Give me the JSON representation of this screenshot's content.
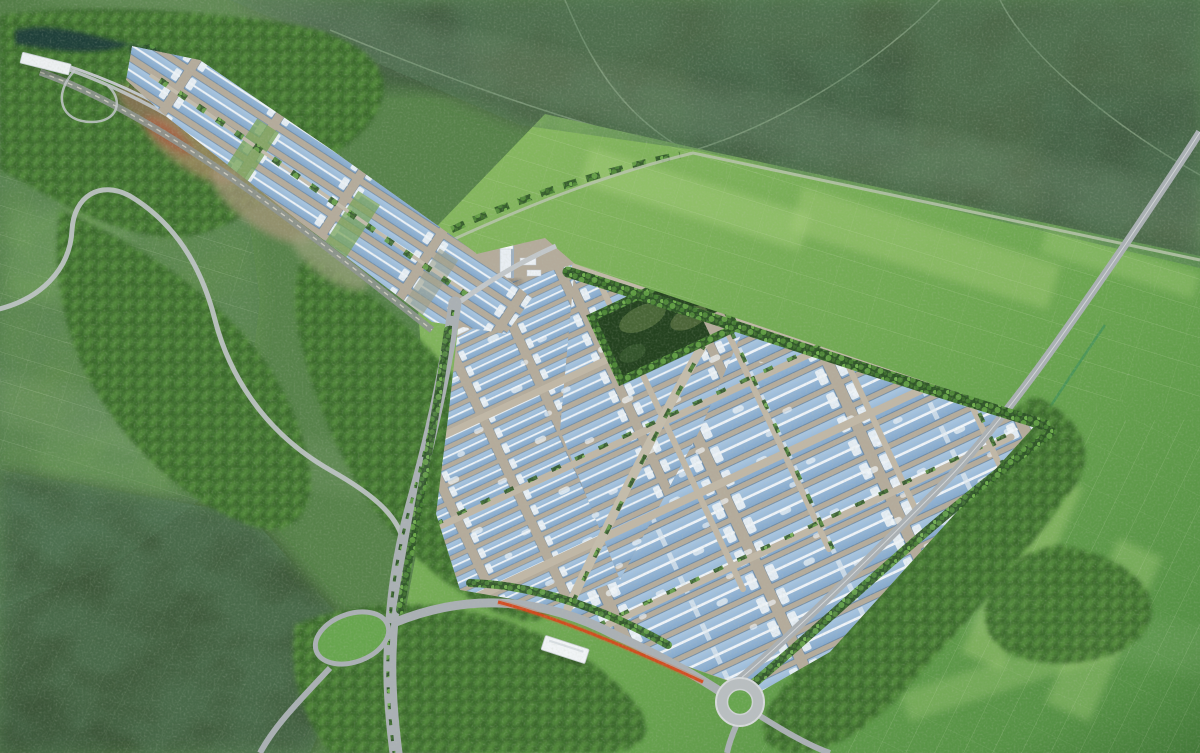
{
  "scene": {
    "type": "aerial-architectural-rendering",
    "subject": "industrial-park-master-plan",
    "elements": [
      "satellite-terrain-band",
      "farmland-left",
      "farmland-bright-east",
      "village-texture-southwest",
      "forest-belts",
      "river-channel",
      "highway-interchange-bridge",
      "rail-corridor",
      "northwest-building-arm",
      "factory-campus",
      "small-warehouse-cluster",
      "medium-warehouse-rows",
      "large-factory-halls",
      "dormitory-cluster",
      "high-rise-tower",
      "central-park-square",
      "main-avenue",
      "entrance-road",
      "red-flower-stripe",
      "entrance-gate-canopy",
      "loop-ramp-island",
      "roundabout",
      "east-boundary-road",
      "field-road"
    ]
  },
  "palette": {
    "bg_base": "#57824a",
    "satellite_olive": "#496142",
    "satellite_dark": "#39503a",
    "field_left": "#628e4e",
    "field_bright": "#7fb35a",
    "field_strip": "#a3cd77",
    "village_dark": "#394f33",
    "forest_dark": "#2e5527",
    "forest_mid": "#4e8637",
    "forest_light": "#6fae4c",
    "road_light": "#c2c7ca",
    "road_mid": "#aab0b4",
    "road_dark": "#8e9590",
    "ground_tan": "#b4ab9b",
    "roof_blue_light": "#aac7e2",
    "roof_blue_dark": "#84a8cc",
    "roof_edge": "#5f7f9f",
    "ridge_white": "#eef3f8",
    "building_white": "#eef2f6",
    "park_dark": "#24421f",
    "water_dark": "#1d3b3a",
    "red_accent": "#d14018",
    "dirt_tan": "#a38a63",
    "dirt_red": "#a6543a",
    "grass_island": "#67a54e"
  }
}
